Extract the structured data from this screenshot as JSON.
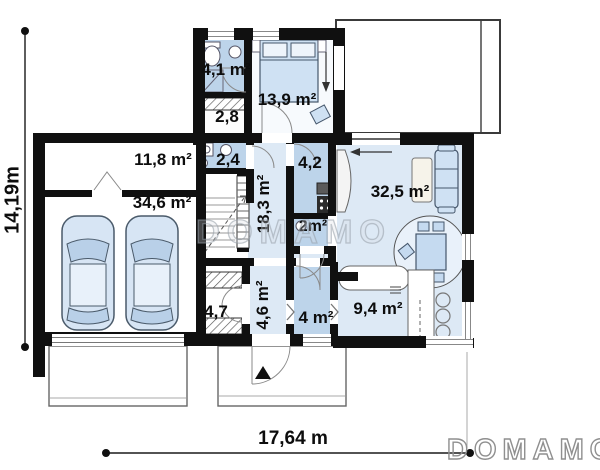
{
  "plan": {
    "rooms": [
      {
        "key": "bathroom-upper",
        "label": "4,1 m²"
      },
      {
        "key": "closet-upper",
        "label": "2,8"
      },
      {
        "key": "bedroom",
        "label": "13,9 m²"
      },
      {
        "key": "utility-room",
        "label": "11,8 m²"
      },
      {
        "key": "bathroom-mid",
        "label": "2,4"
      },
      {
        "key": "pantry",
        "label": "4,2"
      },
      {
        "key": "hall",
        "label": "18,3 m²"
      },
      {
        "key": "living-room",
        "label": "32,5 m²"
      },
      {
        "key": "garage",
        "label": "34,6 m²"
      },
      {
        "key": "wc",
        "label": "2m²"
      },
      {
        "key": "wardrobe",
        "label": "4,7"
      },
      {
        "key": "entry-hall",
        "label": "4,6 m²"
      },
      {
        "key": "bathroom-lower",
        "label": "4 m²"
      },
      {
        "key": "kitchen",
        "label": "9,4 m²"
      }
    ],
    "dimensions": {
      "height": "14,19m",
      "width": "17,64 m"
    },
    "watermark_text": "DOMAMO",
    "brand_logo": "DOMAMO",
    "colors": {
      "wall": "#101010",
      "room_light": "#dde9f5",
      "room_wet": "#bdd4ea",
      "furniture": "#cfe1f3"
    }
  }
}
